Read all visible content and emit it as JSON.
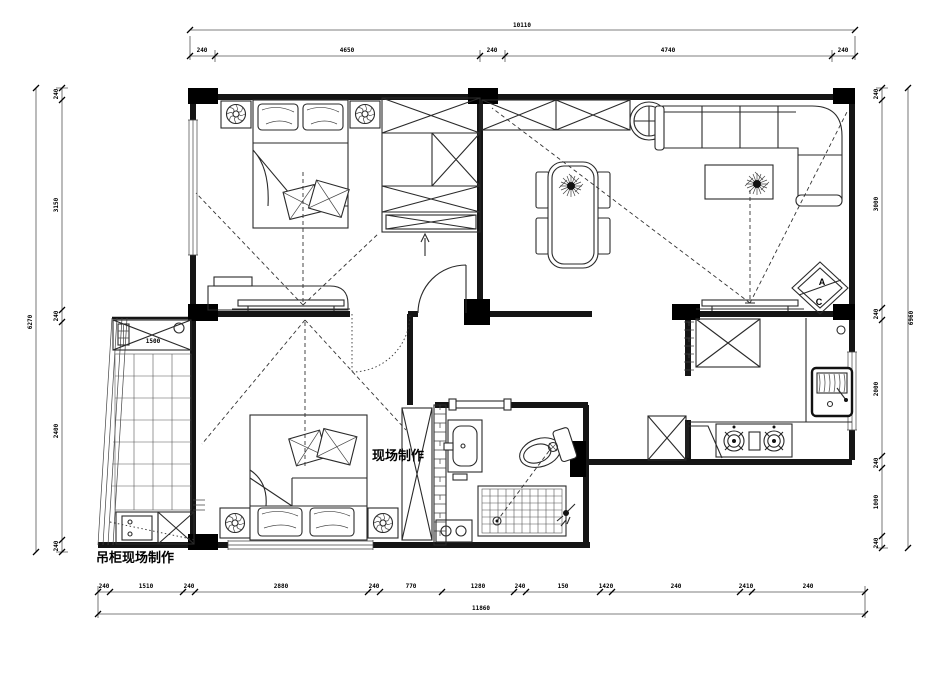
{
  "drawing": {
    "annotations": {
      "onsite_label": "现场制作",
      "hanging_cabinet_label": "吊柜现场制作",
      "section_marker_top": "A",
      "section_marker_bottom": "C"
    },
    "dimensions": {
      "top_total": "10110",
      "top_segments": [
        "240",
        "4650",
        "240",
        "4740",
        "240"
      ],
      "bottom_total": "11860",
      "bottom_segments": [
        "240",
        "1510",
        "240",
        "2880",
        "240",
        "770",
        "1280",
        "240",
        "150",
        "1420",
        "240",
        "2410",
        "240"
      ],
      "left_total": "6270",
      "left_segments": [
        "240",
        "3150",
        "240",
        "2400",
        "240"
      ],
      "right_total": "6960",
      "right_segments": [
        "240",
        "3000",
        "240",
        "2000",
        "240",
        "1000",
        "240"
      ],
      "balcony_cabinet_width": "1500"
    }
  }
}
